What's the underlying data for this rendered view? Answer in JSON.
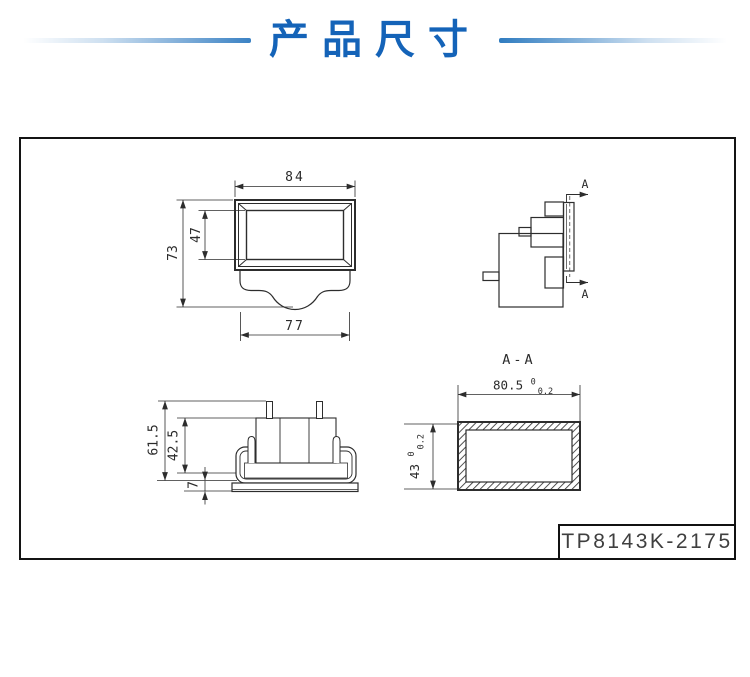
{
  "header": {
    "title": "产品尺寸"
  },
  "colors": {
    "title_blue": "#1463b8",
    "accent_line_blue": "#3b82c4",
    "drawing_line": "#2d2d2d"
  },
  "views": {
    "front": {
      "dim_width_outer": "84",
      "dim_height_outer": "73",
      "dim_height_window": "47",
      "dim_width_bottom": "77"
    },
    "side": {
      "section_arrow_top": "A",
      "section_arrow_bottom": "A"
    },
    "bottom": {
      "dim_height_total": "61.5",
      "dim_height_body": "42.5",
      "dim_flange": "7"
    },
    "section": {
      "title": "A-A",
      "dim_width": {
        "value": "80.5",
        "tol_upper": "0",
        "tol_lower": "0.2"
      },
      "dim_height": {
        "value": "43",
        "tol_upper": "0",
        "tol_lower": "0.2"
      }
    }
  },
  "model_label": "TP8143K-2175"
}
